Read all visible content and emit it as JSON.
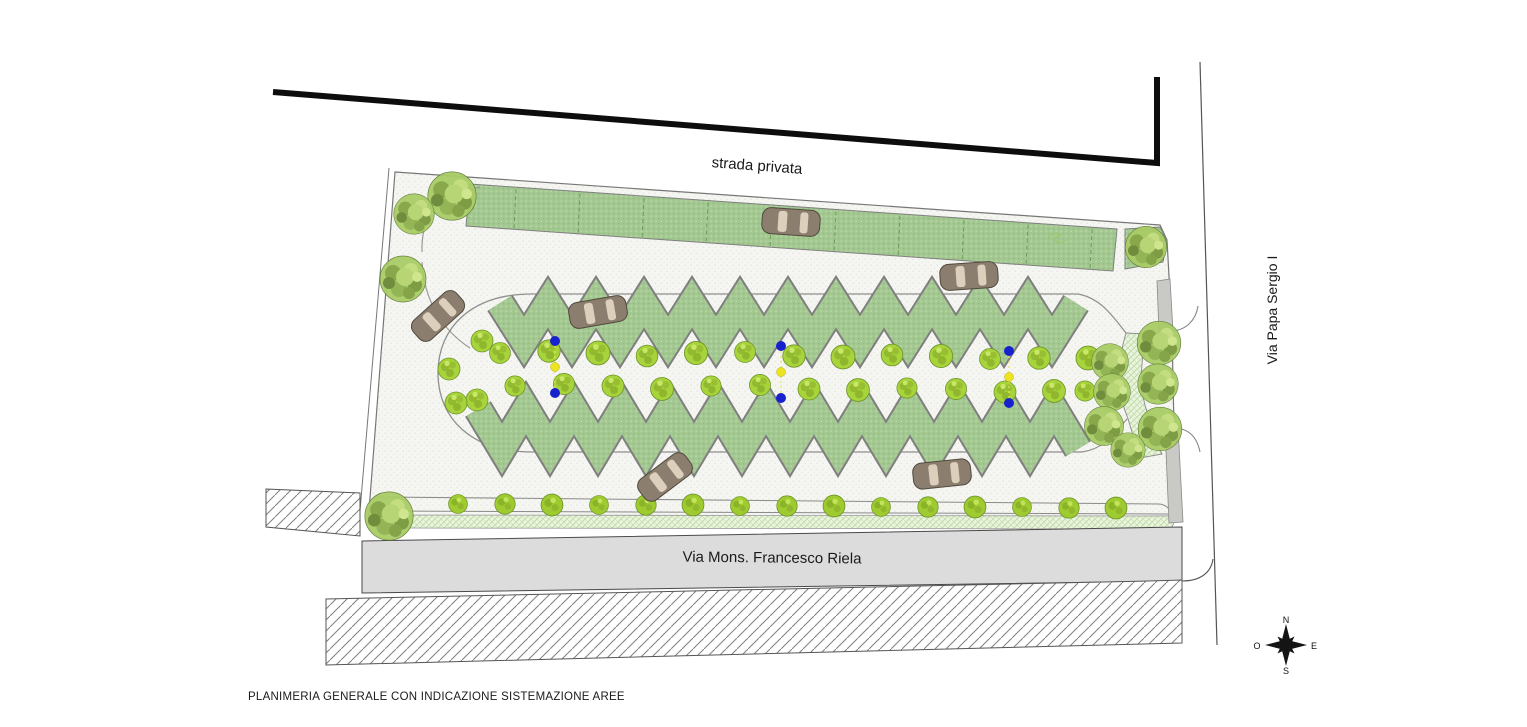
{
  "caption": "PLANIMERIA GENERALE CON INDICAZIONE SISTEMAZIONE AREE",
  "roads": {
    "top": "strada privata",
    "right": "Via Papa Sergio I",
    "bottom": "Via Mons. Francesco Riela"
  },
  "compass": {
    "north": "N",
    "east": "E",
    "south": "S",
    "west": "O"
  },
  "colors": {
    "green_fill": "#a3c891",
    "green_dot_light": "#bedbab",
    "green_dot_dark": "#8fb97c",
    "pavement": "#f5f5f2",
    "pavement_dot": "#e1e1db",
    "tree_green": "#a7d33b",
    "tree_dark": "#84aa28",
    "big_tree_green": "#a9cc66",
    "verge_green": "#eaf4df",
    "verge_line": "#b7d69c",
    "road_gray": "#dcdcdc",
    "sidewalk_gray": "#c9c9c6",
    "outline_gray": "#777777",
    "hatch_line": "#808080",
    "lamp_blue": "#1822cc",
    "lamp_yellow": "#ece421",
    "lamp_wire": "#e8e455",
    "car_body": "#8b7e6e",
    "car_window": "#dccfbc",
    "thick_road_edge": "#0d0d0d",
    "ink": "#1a1a1a"
  },
  "features": {
    "parking_strip": {
      "bay_divider_count": 10
    },
    "cars": [
      {
        "x": 791,
        "y": 222,
        "rot": 4
      },
      {
        "x": 438,
        "y": 316,
        "rot": -42
      },
      {
        "x": 598,
        "y": 312,
        "rot": -10
      },
      {
        "x": 969,
        "y": 276,
        "rot": -4
      },
      {
        "x": 665,
        "y": 477,
        "rot": -37
      },
      {
        "x": 942,
        "y": 474,
        "rot": -6
      }
    ],
    "lamp_clusters": [
      {
        "x": 555,
        "cy": 367
      },
      {
        "x": 781,
        "cy": 372
      },
      {
        "x": 1009,
        "cy": 377
      }
    ],
    "corridor_tree_columns": 13,
    "cap_trees": [
      [
        482,
        341
      ],
      [
        449,
        369
      ],
      [
        477,
        400
      ],
      [
        456,
        403
      ]
    ],
    "corner_trees": [
      [
        452,
        196,
        1.05
      ],
      [
        414,
        214,
        0.88
      ],
      [
        403,
        279,
        1.0
      ],
      [
        389,
        516,
        1.05
      ],
      [
        1146,
        247,
        0.9
      ],
      [
        1159,
        343,
        0.95
      ],
      [
        1110,
        362,
        0.8
      ],
      [
        1112,
        392,
        0.8
      ],
      [
        1158,
        384,
        0.88
      ],
      [
        1104,
        426,
        0.85
      ],
      [
        1160,
        429,
        0.95
      ],
      [
        1128,
        450,
        0.75
      ]
    ],
    "bush_row": {
      "x_start": 458,
      "x_end": 1162,
      "step": 47
    },
    "zigzag": {
      "top": {
        "x0": 500,
        "count": 25,
        "step": 24,
        "y_hi": 303,
        "y_lo": 341
      },
      "bottom": {
        "x0": 478,
        "count": 26,
        "step": 24,
        "y_hi": 409,
        "y_lo": 449
      }
    },
    "compass_center": {
      "x": 1286,
      "y": 645
    }
  }
}
